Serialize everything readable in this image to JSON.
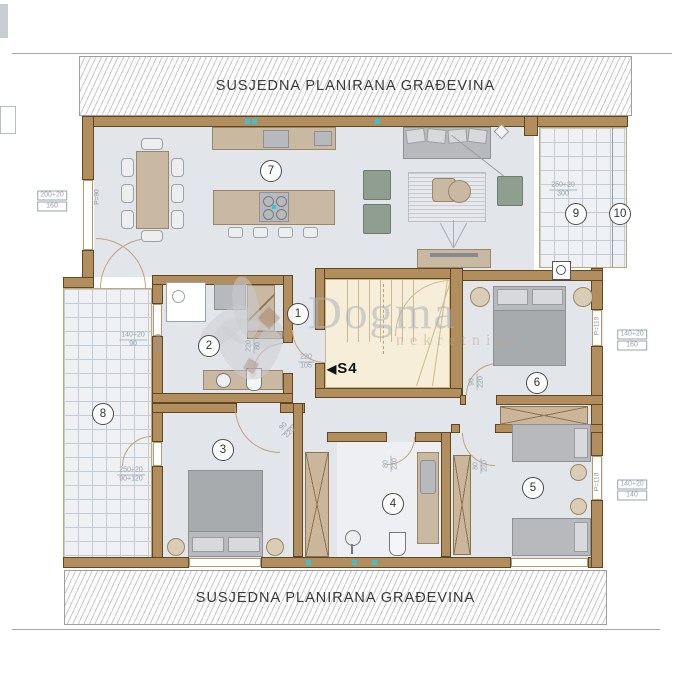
{
  "banners": {
    "top": "SUSJEDNA PLANIRANA GRAĐEVINA",
    "bottom": "SUSJEDNA PLANIRANA GRAĐEVINA"
  },
  "watermark": {
    "name": "Dogma",
    "subtitle": "nekretnine"
  },
  "stairs": {
    "arrow": "◀",
    "label": "S4"
  },
  "room_badges": [
    {
      "num": "1",
      "x": 297,
      "y": 313
    },
    {
      "num": "2",
      "x": 208,
      "y": 345
    },
    {
      "num": "3",
      "x": 222,
      "y": 449
    },
    {
      "num": "4",
      "x": 392,
      "y": 503
    },
    {
      "num": "5",
      "x": 532,
      "y": 487
    },
    {
      "num": "6",
      "x": 536,
      "y": 382
    },
    {
      "num": "7",
      "x": 270,
      "y": 170
    },
    {
      "num": "8",
      "x": 102,
      "y": 413
    },
    {
      "num": "9",
      "x": 575,
      "y": 213
    },
    {
      "num": "10",
      "x": 619,
      "y": 213
    }
  ],
  "dim_labels": [
    {
      "lines": [
        "200+20",
        "160"
      ],
      "x": 52,
      "y": 201,
      "boxed": true
    },
    {
      "lines": [
        "250+20",
        "300"
      ],
      "x": 563,
      "y": 190
    },
    {
      "lines": [
        "140+20",
        "90"
      ],
      "x": 133,
      "y": 340
    },
    {
      "lines": [
        "250+20",
        "90+120"
      ],
      "x": 131,
      "y": 475
    },
    {
      "lines": [
        "140+20",
        "160"
      ],
      "x": 632,
      "y": 340,
      "boxed": true
    },
    {
      "lines": [
        "140+20",
        "140"
      ],
      "x": 632,
      "y": 490,
      "boxed": true
    },
    {
      "lines": [
        "220",
        "105"
      ],
      "x": 306,
      "y": 362
    },
    {
      "lines": [
        "220",
        "80"
      ],
      "x": 254,
      "y": 346,
      "rot": -90
    },
    {
      "lines": [
        "80",
        "220"
      ],
      "x": 391,
      "y": 464,
      "rot": -90
    },
    {
      "lines": [
        "80",
        "220"
      ],
      "x": 481,
      "y": 466,
      "rot": -90
    },
    {
      "lines": [
        "90",
        "220"
      ],
      "x": 477,
      "y": 382,
      "rot": -90
    },
    {
      "lines": [
        "90",
        "220"
      ],
      "x": 287,
      "y": 430,
      "rot": -45
    }
  ],
  "wall_labels": [
    {
      "text": "P=90",
      "x": 97,
      "y": 197
    },
    {
      "text": "P=110",
      "x": 159,
      "y": 343
    },
    {
      "text": "P=110",
      "x": 597,
      "y": 326
    },
    {
      "text": "P=110",
      "x": 597,
      "y": 482
    }
  ],
  "colors": {
    "wall": "#b28e5e",
    "floor": "#e2e5ea",
    "stair_floor": "#f6eed8",
    "tile_line": "#c3cbd4",
    "accent_teal": "#3bc0d4",
    "furniture_tan": "#c9b8a2",
    "furniture_gray": "#b7b9bc",
    "chair_green": "#8f9e8e"
  }
}
